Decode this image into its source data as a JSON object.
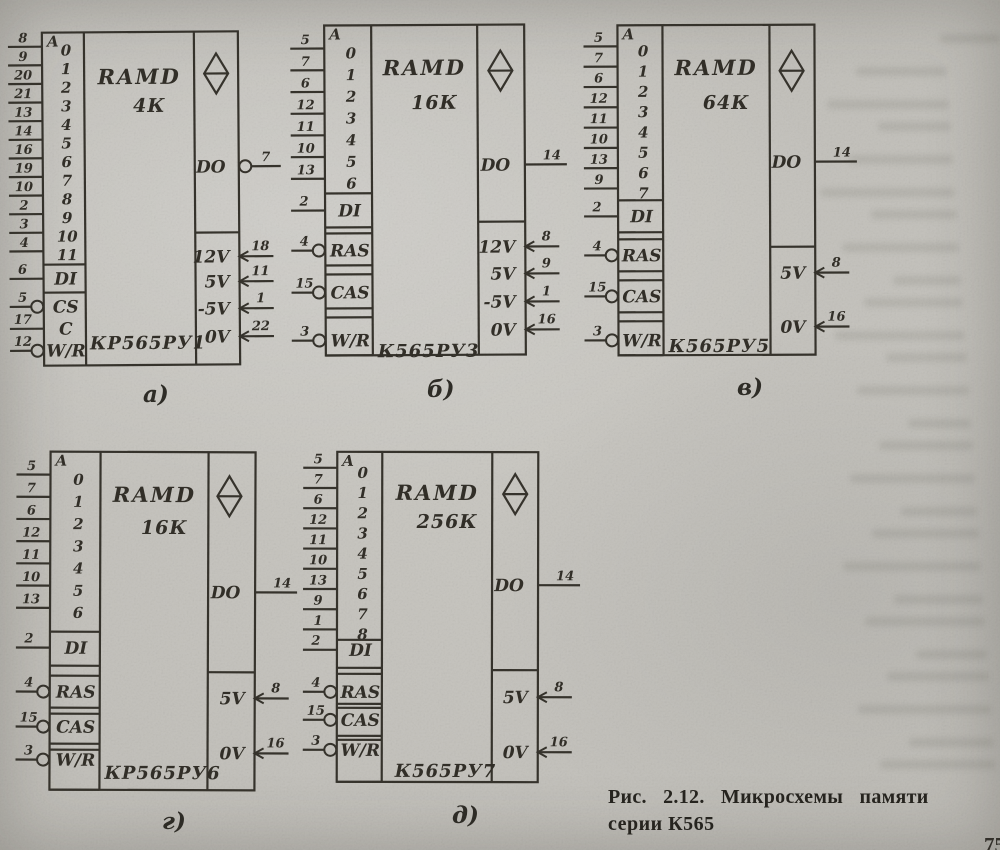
{
  "figure": {
    "caption_line1": "Рис. 2.12. Микросхемы памяти",
    "caption_line2": "серии К565",
    "page_number": "75"
  },
  "colors": {
    "ink": "#36332c",
    "paper": "#c6c4be"
  },
  "chips": [
    {
      "letter": "а)",
      "letter_x": 143,
      "letter_y": 381,
      "part": "КР565РУ1",
      "title": "RAMD",
      "capacity": "4К",
      "addr_label": "A",
      "box": {
        "x": 43,
        "y": 32,
        "w": 196,
        "h": 333
      },
      "col1": 42,
      "col2": 152,
      "tilt": -0.4,
      "addr": {
        "y0": 14,
        "dy": 18.6,
        "items": [
          {
            "d": "0",
            "p": "8"
          },
          {
            "d": "1",
            "p": "9"
          },
          {
            "d": "2",
            "p": "20"
          },
          {
            "d": "3",
            "p": "21"
          },
          {
            "d": "4",
            "p": "13"
          },
          {
            "d": "5",
            "p": "14"
          },
          {
            "d": "6",
            "p": "16"
          },
          {
            "d": "7",
            "p": "19"
          },
          {
            "d": "8",
            "p": "10"
          },
          {
            "d": "9",
            "p": "2"
          },
          {
            "d": "10",
            "p": "3"
          },
          {
            "d": "11",
            "p": "4"
          }
        ]
      },
      "controls": [
        {
          "label": "DI",
          "pin": "6",
          "inv": false,
          "y": 246,
          "box": [
            232,
            260
          ]
        },
        {
          "label": "CS",
          "pin": "5",
          "inv": true,
          "y": 274
        },
        {
          "label": "C",
          "pin": "17",
          "inv": false,
          "y": 296
        },
        {
          "label": "W/R",
          "pin": "12",
          "inv": true,
          "y": 318
        }
      ],
      "out": {
        "label": "DO",
        "pin": "7",
        "inv": true,
        "y": 135
      },
      "pwr_div": 201,
      "power": [
        {
          "label": "12V",
          "pin": "18",
          "y": 225
        },
        {
          "label": "5V",
          "pin": "11",
          "y": 250
        },
        {
          "label": "-5V",
          "pin": "1",
          "y": 277
        },
        {
          "label": "0V",
          "pin": "22",
          "y": 305
        }
      ],
      "diamond": {
        "cx": 174,
        "cy": 26
      },
      "title_y": 30,
      "cap_y": 58,
      "part_y": 295,
      "part_x": 46
    },
    {
      "letter": "б)",
      "letter_x": 427,
      "letter_y": 376,
      "part": "К565РУ3",
      "title": "RAMD",
      "capacity": "16К",
      "addr_label": "A",
      "box": {
        "x": 325,
        "y": 25,
        "w": 200,
        "h": 330
      },
      "col1": 47,
      "col2": 153,
      "tilt": -0.3,
      "addr": {
        "y0": 23,
        "dy": 21.7,
        "items": [
          {
            "d": "0",
            "p": "5"
          },
          {
            "d": "1",
            "p": "7"
          },
          {
            "d": "2",
            "p": "6"
          },
          {
            "d": "3",
            "p": "12"
          },
          {
            "d": "4",
            "p": "11"
          },
          {
            "d": "5",
            "p": "10"
          },
          {
            "d": "6",
            "p": "13"
          }
        ]
      },
      "controls": [
        {
          "label": "DI",
          "pin": "2",
          "inv": false,
          "y": 185,
          "box": [
            168,
            202
          ]
        },
        {
          "label": "RAS",
          "pin": "4",
          "inv": true,
          "y": 225,
          "box": [
            208,
            240
          ]
        },
        {
          "label": "CAS",
          "pin": "15",
          "inv": true,
          "y": 267,
          "box": [
            249,
            283
          ]
        },
        {
          "label": "W/R",
          "pin": "3",
          "inv": true,
          "y": 315,
          "box": [
            292,
            330
          ]
        }
      ],
      "out": {
        "label": "DO",
        "pin": "14",
        "inv": false,
        "y": 140
      },
      "pwr_div": 197,
      "power": [
        {
          "label": "12V",
          "pin": "8",
          "y": 222
        },
        {
          "label": "5V",
          "pin": "9",
          "y": 249
        },
        {
          "label": "-5V",
          "pin": "1",
          "y": 277
        },
        {
          "label": "0V",
          "pin": "16",
          "y": 305
        }
      ],
      "diamond": {
        "cx": 176,
        "cy": 30
      },
      "title_y": 28,
      "cap_y": 62,
      "part_y": 310,
      "part_x": 52
    },
    {
      "letter": "в)",
      "letter_x": 737,
      "letter_y": 374,
      "part": "К565РУ5",
      "title": "RAMD",
      "capacity": "64К",
      "addr_label": "A",
      "box": {
        "x": 618,
        "y": 25,
        "w": 197,
        "h": 330
      },
      "col1": 45,
      "col2": 152,
      "tilt": -0.2,
      "addr": {
        "y0": 21,
        "dy": 20.3,
        "items": [
          {
            "d": "0",
            "p": "5"
          },
          {
            "d": "1",
            "p": "7"
          },
          {
            "d": "2",
            "p": "6"
          },
          {
            "d": "3",
            "p": "12"
          },
          {
            "d": "4",
            "p": "11"
          },
          {
            "d": "5",
            "p": "10"
          },
          {
            "d": "6",
            "p": "13"
          },
          {
            "d": "7",
            "p": "9"
          }
        ]
      },
      "controls": [
        {
          "label": "DI",
          "pin": "2",
          "inv": false,
          "y": 191,
          "box": [
            175,
            207
          ]
        },
        {
          "label": "RAS",
          "pin": "4",
          "inv": true,
          "y": 230,
          "box": [
            214,
            246
          ]
        },
        {
          "label": "CAS",
          "pin": "15",
          "inv": true,
          "y": 271,
          "box": [
            255,
            287
          ]
        },
        {
          "label": "W/R",
          "pin": "3",
          "inv": true,
          "y": 315,
          "box": [
            296,
            330
          ]
        }
      ],
      "out": {
        "label": "DO",
        "pin": "14",
        "inv": false,
        "y": 137
      },
      "pwr_div": 222,
      "power": [
        {
          "label": "5V",
          "pin": "8",
          "y": 248
        },
        {
          "label": "0V",
          "pin": "16",
          "y": 302
        }
      ],
      "diamond": {
        "cx": 174,
        "cy": 30
      },
      "title_y": 28,
      "cap_y": 62,
      "part_y": 305,
      "part_x": 50
    },
    {
      "letter": "г)",
      "letter_x": 162,
      "letter_y": 808,
      "part": "КР565РУ6",
      "title": "RAMD",
      "capacity": "16К",
      "addr_label": "A",
      "box": {
        "x": 50,
        "y": 452,
        "w": 205,
        "h": 338
      },
      "col1": 50,
      "col2": 158,
      "tilt": 0.2,
      "addr": {
        "y0": 23,
        "dy": 22.2,
        "items": [
          {
            "d": "0",
            "p": "5"
          },
          {
            "d": "1",
            "p": "7"
          },
          {
            "d": "2",
            "p": "6"
          },
          {
            "d": "3",
            "p": "12"
          },
          {
            "d": "4",
            "p": "11"
          },
          {
            "d": "5",
            "p": "10"
          },
          {
            "d": "6",
            "p": "13"
          }
        ]
      },
      "controls": [
        {
          "label": "DI",
          "pin": "2",
          "inv": false,
          "y": 196,
          "box": [
            180,
            214
          ]
        },
        {
          "label": "RAS",
          "pin": "4",
          "inv": true,
          "y": 240,
          "box": [
            224,
            256
          ]
        },
        {
          "label": "CAS",
          "pin": "15",
          "inv": true,
          "y": 275,
          "box": [
            262,
            292
          ]
        },
        {
          "label": "W/R",
          "pin": "3",
          "inv": true,
          "y": 308,
          "box": [
            298,
            338
          ]
        }
      ],
      "out": {
        "label": "DO",
        "pin": "14",
        "inv": false,
        "y": 140
      },
      "pwr_div": 220,
      "power": [
        {
          "label": "5V",
          "pin": "8",
          "y": 246
        },
        {
          "label": "0V",
          "pin": "16",
          "y": 301
        }
      ],
      "diamond": {
        "cx": 179,
        "cy": 28
      },
      "title_y": 28,
      "cap_y": 60,
      "part_y": 305,
      "part_x": 55
    },
    {
      "letter": "д)",
      "letter_x": 452,
      "letter_y": 802,
      "part": "К565РУ7",
      "title": "RAMD",
      "capacity": "256К",
      "addr_label": "A",
      "box": {
        "x": 337,
        "y": 452,
        "w": 201,
        "h": 330
      },
      "col1": 45,
      "col2": 155,
      "tilt": 0.1,
      "addr": {
        "y0": 16,
        "dy": 20.2,
        "items": [
          {
            "d": "0",
            "p": "5"
          },
          {
            "d": "1",
            "p": "7"
          },
          {
            "d": "2",
            "p": "6"
          },
          {
            "d": "3",
            "p": "12"
          },
          {
            "d": "4",
            "p": "11"
          },
          {
            "d": "5",
            "p": "10"
          },
          {
            "d": "6",
            "p": "13"
          },
          {
            "d": "7",
            "p": "9"
          },
          {
            "d": "8",
            "p": "1"
          }
        ]
      },
      "controls": [
        {
          "label": "DI",
          "pin": "2",
          "inv": false,
          "y": 198,
          "box": [
            188,
            216
          ]
        },
        {
          "label": "RAS",
          "pin": "4",
          "inv": true,
          "y": 240,
          "box": [
            222,
            252
          ]
        },
        {
          "label": "CAS",
          "pin": "15",
          "inv": true,
          "y": 268,
          "box": [
            256,
            284
          ]
        },
        {
          "label": "W/R",
          "pin": "3",
          "inv": true,
          "y": 298,
          "box": [
            288,
            330
          ]
        }
      ],
      "out": {
        "label": "DO",
        "pin": "14",
        "inv": false,
        "y": 133
      },
      "pwr_div": 218,
      "power": [
        {
          "label": "5V",
          "pin": "8",
          "y": 245
        },
        {
          "label": "0V",
          "pin": "16",
          "y": 300
        }
      ],
      "diamond": {
        "cx": 178,
        "cy": 26
      },
      "title_y": 26,
      "cap_y": 54,
      "part_y": 303,
      "part_x": 58
    }
  ]
}
